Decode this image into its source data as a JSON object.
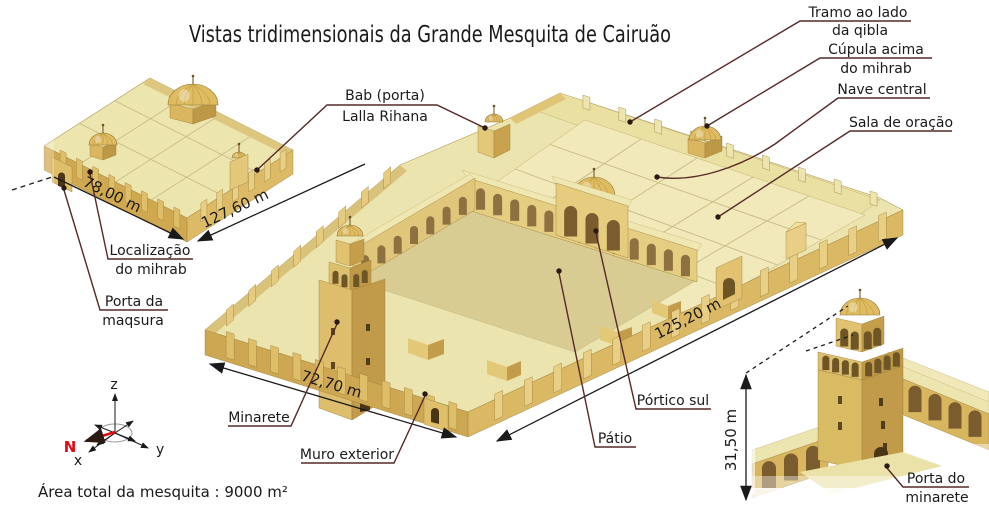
{
  "title": "Vistas tridimensionais da Grande Mesquita de Cairuão",
  "footer": {
    "area_text": "Área total da mesquita : 9000 m²"
  },
  "labels": {
    "tramo": {
      "line1": "Tramo ao lado",
      "line2": "da qibla"
    },
    "cupula": {
      "line1": "Cúpula acima",
      "line2": "do mihrab"
    },
    "nave": "Nave central",
    "sala": "Sala de oração",
    "bab": {
      "line1": "Bab (porta)",
      "line2": "Lalla Rihana"
    },
    "localizacao": {
      "line1": "Localização",
      "line2": "do mihrab"
    },
    "maqsura": {
      "line1": "Porta da",
      "line2": "maqsura"
    },
    "minarete": "Minarete",
    "muro": "Muro exterior",
    "patio": "Pátio",
    "portico": "Pórtico sul",
    "porta_minarete": {
      "line1": "Porta do",
      "line2": "minarete"
    }
  },
  "dimensions": {
    "mini_front": "78,00 m",
    "mini_side": "127,60 m",
    "main_front": "72,70 m",
    "main_side": "125,20 m",
    "minaret_height": "31,50 m"
  },
  "compass": {
    "north": "N",
    "axis_x": "x",
    "axis_y": "y",
    "axis_z": "z"
  },
  "colors": {
    "leader_maroon": "#552a28",
    "north_red": "#e30613",
    "roof_pale": "#ece4ae",
    "roof_light": "#f1e9ba",
    "wall_light": "#dfbe69",
    "wall_shadow": "#c19b49",
    "courtyard": "#d8cc93",
    "arch_opening": "#8e7140",
    "outline": "#1a1a1a"
  }
}
